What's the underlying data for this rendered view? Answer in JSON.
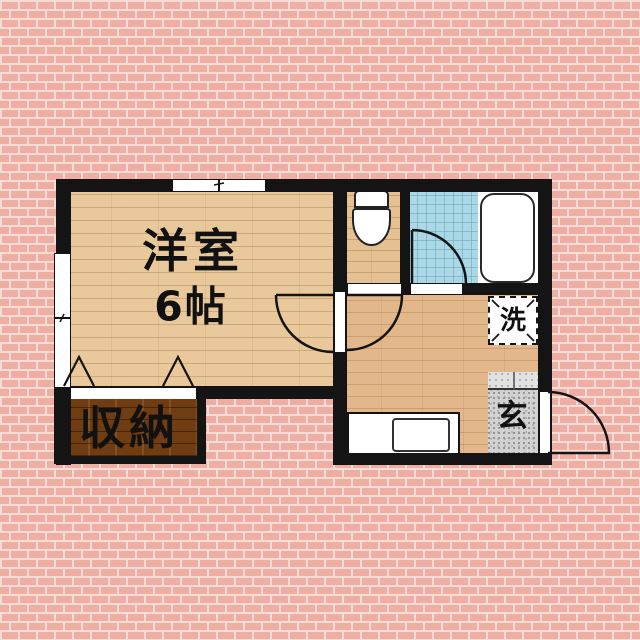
{
  "floorplan": {
    "rooms": {
      "western_room": {
        "name": "洋室",
        "size": "6帖"
      },
      "closet": {
        "label": "収納"
      },
      "washer_space": {
        "label": "洗"
      },
      "entrance": {
        "label": "玄"
      }
    },
    "colors": {
      "wall": "#141414",
      "brick_background": "#efaea3",
      "wood_floor": "#e9c89c",
      "kitchen_floor": "#e2b78b",
      "closet_wood": "#6f3d11",
      "bath_tile": "#abd8e4",
      "genkan_gray": "#d2d2d2"
    },
    "fixture_icons": [
      "toilet-icon",
      "bathtub-icon",
      "kitchen-sink-icon",
      "washing-machine-pad",
      "door-swing-arc",
      "window-symbol",
      "folding-door-symbol"
    ]
  }
}
